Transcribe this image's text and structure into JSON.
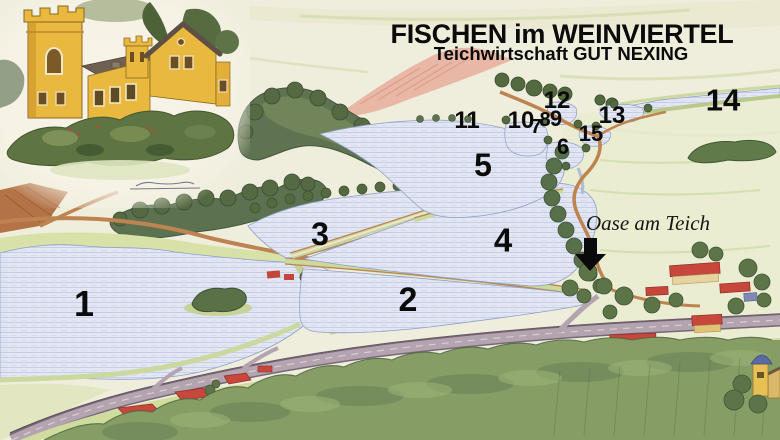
{
  "header": {
    "title": "FISCHEN im WEINVIERTEL",
    "subtitle": "Teichwirtschaft GUT NEXING"
  },
  "annotation": {
    "label": "Oase am Teich"
  },
  "icons": {
    "annotation_arrow": "down-arrow-icon"
  },
  "ponds": {
    "p1": "1",
    "p2": "2",
    "p3": "3",
    "p4": "4",
    "p5": "5",
    "p6": "6",
    "p7": "7",
    "p8": "8",
    "p9": "9",
    "p10": "10",
    "p11": "11",
    "p12": "12",
    "p13": "13",
    "p14": "14",
    "p15": "15"
  },
  "palette": {
    "background": "#efeedd",
    "water": "#e2e7f3",
    "water_lines": "#a9b4d6",
    "forest": "#5f7351",
    "meadow": "#d8e2a8",
    "road_orange": "#bd8350",
    "road_grey": "#b2a3b0",
    "roof_red": "#c8473c",
    "manor_yellow": "#e9b83e",
    "field_pink": "#e7ad9c",
    "text": "#0b0b0b"
  }
}
